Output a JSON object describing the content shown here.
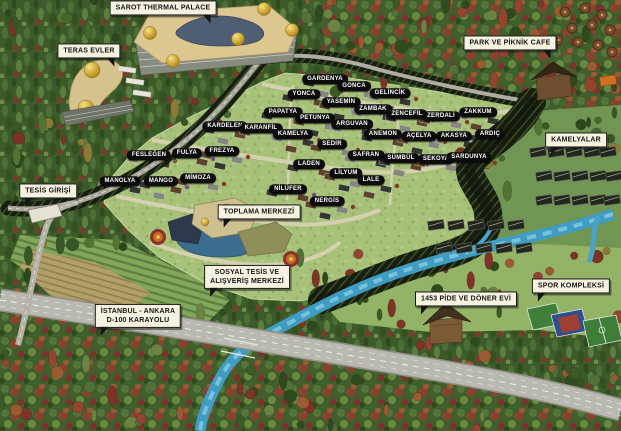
{
  "map_title": "SAROT THERMAL PALACE",
  "site_labels": [
    {
      "name": "GARDENYA",
      "x": 325,
      "y": 79
    },
    {
      "name": "GONCA",
      "x": 354,
      "y": 86
    },
    {
      "name": "GELİNCİK",
      "x": 390,
      "y": 93
    },
    {
      "name": "YONCA",
      "x": 304,
      "y": 94
    },
    {
      "name": "YASEMİN",
      "x": 341,
      "y": 102
    },
    {
      "name": "ZAMBAK",
      "x": 373,
      "y": 109
    },
    {
      "name": "ZENCEFİL",
      "x": 407,
      "y": 114
    },
    {
      "name": "ZERDALİ",
      "x": 441,
      "y": 116
    },
    {
      "name": "ZAKKUM",
      "x": 478,
      "y": 112
    },
    {
      "name": "PAPATYA",
      "x": 283,
      "y": 112
    },
    {
      "name": "PETUNYA",
      "x": 315,
      "y": 118
    },
    {
      "name": "ARGUVAN",
      "x": 352,
      "y": 124
    },
    {
      "name": "KARDELEN",
      "x": 225,
      "y": 126
    },
    {
      "name": "KARANFİL",
      "x": 261,
      "y": 128
    },
    {
      "name": "KAMELYA",
      "x": 293,
      "y": 134
    },
    {
      "name": "ANEMON",
      "x": 383,
      "y": 134
    },
    {
      "name": "AÇELYA",
      "x": 419,
      "y": 136
    },
    {
      "name": "AKASYA",
      "x": 454,
      "y": 136
    },
    {
      "name": "ARDIÇ",
      "x": 490,
      "y": 134
    },
    {
      "name": "SEDİR",
      "x": 332,
      "y": 144
    },
    {
      "name": "FESLEĞEN",
      "x": 149,
      "y": 155
    },
    {
      "name": "FULYA",
      "x": 187,
      "y": 153
    },
    {
      "name": "FREZYA",
      "x": 222,
      "y": 151
    },
    {
      "name": "SAFRAN",
      "x": 366,
      "y": 155
    },
    {
      "name": "SÜMBÜL",
      "x": 401,
      "y": 158
    },
    {
      "name": "SEKOYA",
      "x": 436,
      "y": 159
    },
    {
      "name": "SARDUNYA",
      "x": 469,
      "y": 157
    },
    {
      "name": "LADEN",
      "x": 309,
      "y": 164
    },
    {
      "name": "LİLYUM",
      "x": 346,
      "y": 173
    },
    {
      "name": "MANOLYA",
      "x": 120,
      "y": 181
    },
    {
      "name": "MANGO",
      "x": 161,
      "y": 181
    },
    {
      "name": "MİMOZA",
      "x": 198,
      "y": 178
    },
    {
      "name": "LALE",
      "x": 371,
      "y": 180
    },
    {
      "name": "NİLÜFER",
      "x": 288,
      "y": 189
    },
    {
      "name": "NERGİS",
      "x": 327,
      "y": 201
    }
  ],
  "callouts": [
    {
      "id": "sarot-thermal-palace",
      "lines": [
        "SAROT THERMAL PALACE"
      ],
      "x": 163,
      "y": 8,
      "tail": "br"
    },
    {
      "id": "teras-evler",
      "lines": [
        "TERAS EVLER"
      ],
      "x": 89,
      "y": 51,
      "tail": "br"
    },
    {
      "id": "tesis-girisi",
      "lines": [
        "TESİS GİRİŞİ"
      ],
      "x": 48,
      "y": 191,
      "tail": "bl"
    },
    {
      "id": "park-ve-piknik-cafe",
      "lines": [
        "PARK VE PİKNİK CAFE"
      ],
      "x": 510,
      "y": 43,
      "tail": "br"
    },
    {
      "id": "kamelyalar",
      "lines": [
        "KAMELYALAR"
      ],
      "x": 576,
      "y": 140,
      "tail": "bl"
    },
    {
      "id": "toplama-merkezi",
      "lines": [
        "TOPLAMA MERKEZİ"
      ],
      "x": 259,
      "y": 212,
      "tail": "bl"
    },
    {
      "id": "sosyal-tesis-ve-alisveris-merkezi",
      "lines": [
        "SOSYAL TESİS VE",
        "ALIŞVERİŞ MERKEZİ"
      ],
      "x": 247,
      "y": 277,
      "tail": "bl"
    },
    {
      "id": "istanbul-ankara-d100-karayolu",
      "lines": [
        "İSTANBUL - ANKARA",
        "D-100 KARAYOLU"
      ],
      "x": 138,
      "y": 316,
      "tail": "bl"
    },
    {
      "id": "1453-pide-ve-doner-evi",
      "lines": [
        "1453 PİDE VE DÖNER EVİ"
      ],
      "x": 466,
      "y": 299,
      "tail": "bl"
    },
    {
      "id": "spor-kompleksi",
      "lines": [
        "SPOR KOMPLEKSİ"
      ],
      "x": 571,
      "y": 286,
      "tail": "bl"
    }
  ],
  "colors": {
    "label_pill_bg": "#0c0c0c",
    "label_pill_text": "#ffffff",
    "callout_bg": "#f6f2e0",
    "callout_border": "#151515",
    "river_blue": "#3f9cc2",
    "highway_gray": "#b9b9b1",
    "forest_green": "#3d5a2b",
    "autumn_red": "#8e4030",
    "village_green": "#a7c179",
    "dome_gold": "#caa22e",
    "roof_pool_blue": "#4f5e72"
  }
}
